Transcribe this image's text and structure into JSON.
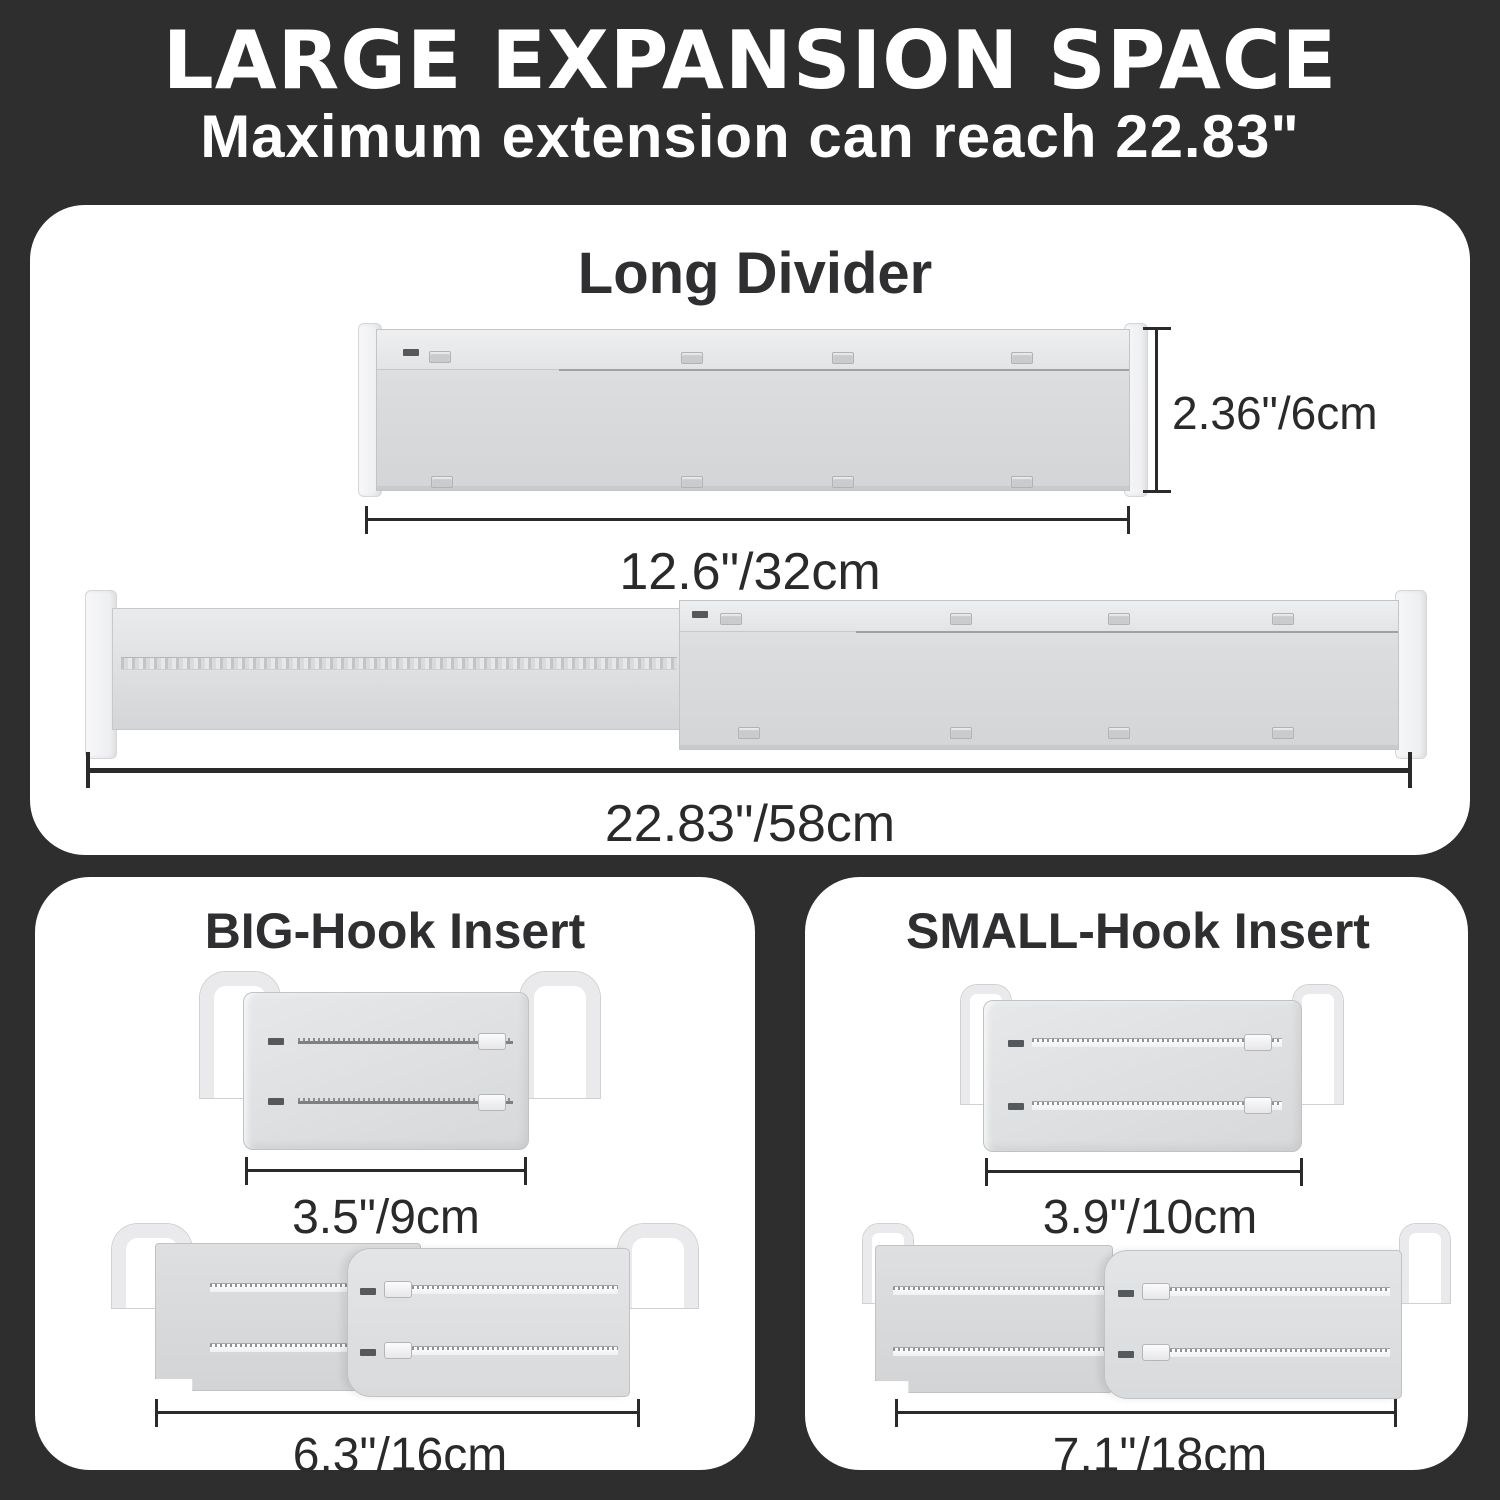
{
  "header": {
    "title": "LARGE EXPANSION SPACE",
    "subtitle": "Maximum extension can reach 22.83\""
  },
  "long_divider": {
    "heading": "Long Divider",
    "collapsed_height_label": "2.36\"/6cm",
    "collapsed_width_label": "12.6\"/32cm",
    "extended_width_label": "22.83\"/58cm"
  },
  "big_hook_insert": {
    "heading": "BIG-Hook Insert",
    "collapsed_width_label": "3.5\"/9cm",
    "extended_width_label": "6.3\"/16cm"
  },
  "small_hook_insert": {
    "heading": "SMALL-Hook Insert",
    "collapsed_width_label": "3.9\"/10cm",
    "extended_width_label": "7.1\"/18cm"
  },
  "colors": {
    "background": "#2e2e2e",
    "panel": "#ffffff",
    "heading_text": "#2f2f31",
    "dimension_text": "#2a2a2a",
    "product_gray": "#d9dbdd"
  }
}
